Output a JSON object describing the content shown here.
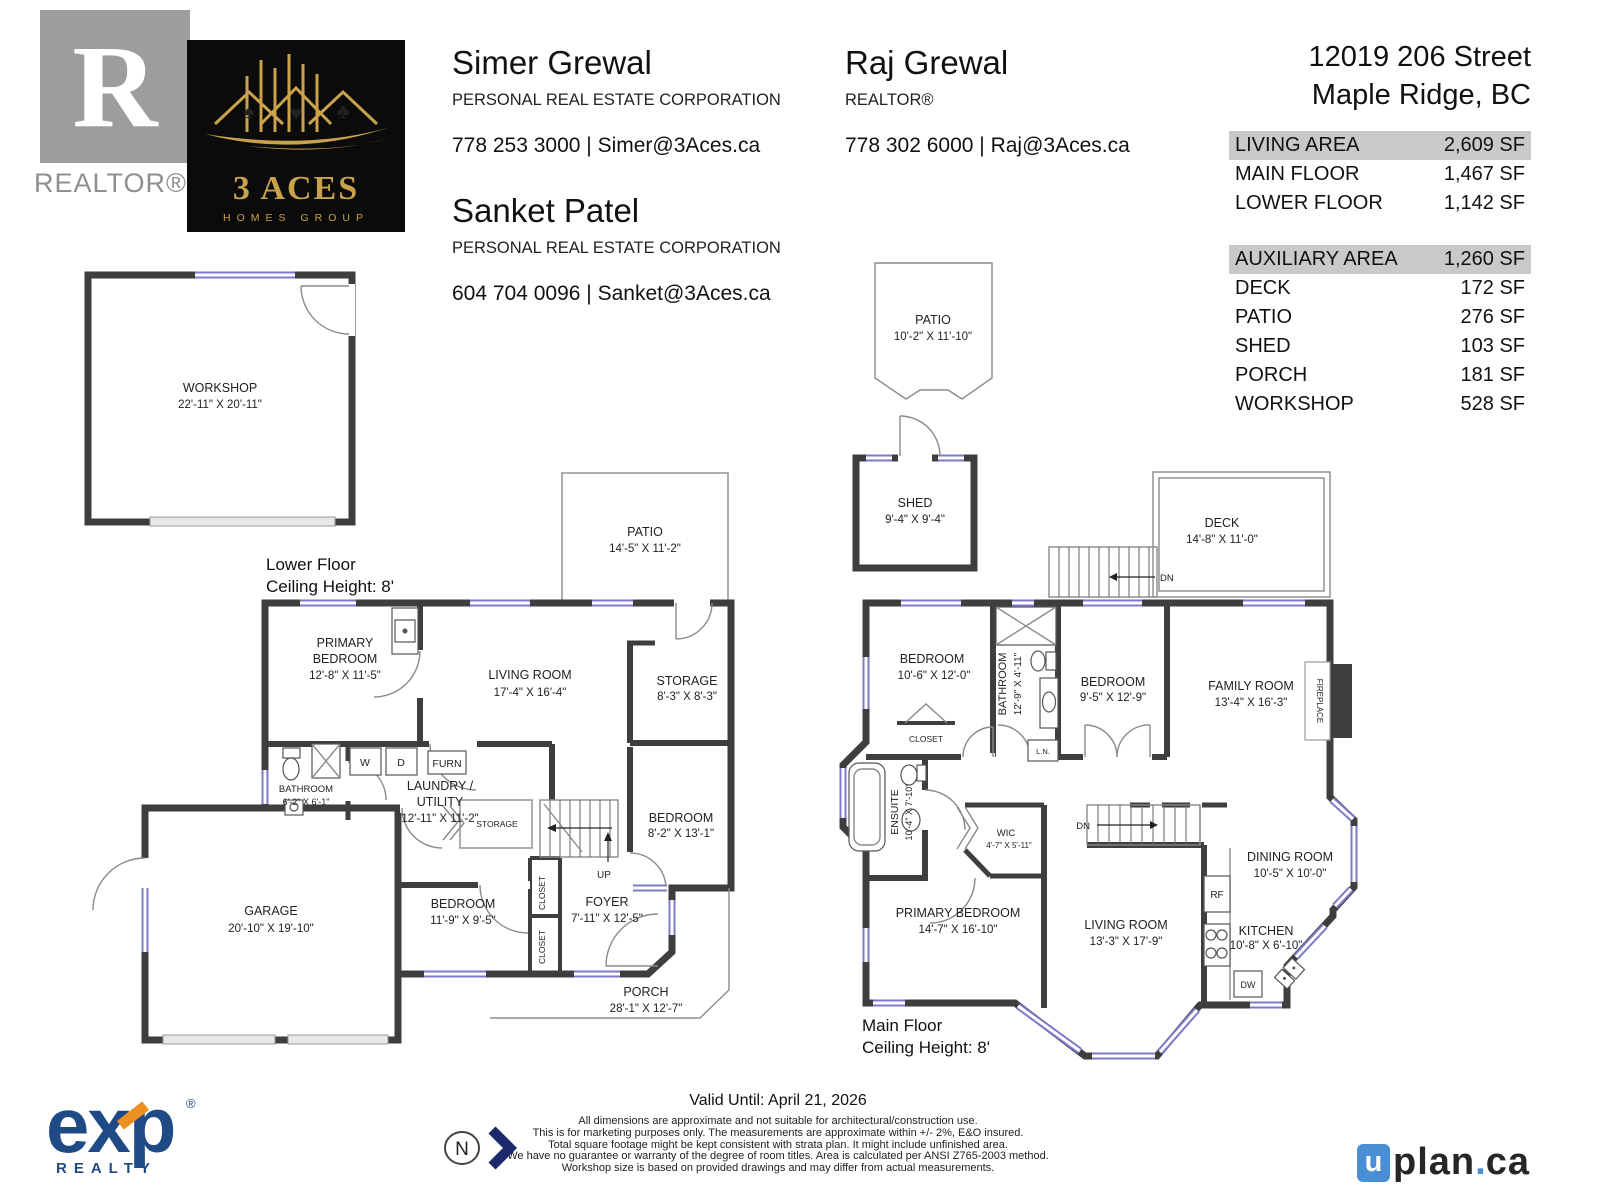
{
  "header": {
    "realtor_mark": {
      "letter": "R",
      "label": "REALTOR®"
    },
    "brokerage": {
      "name": "3 ACES",
      "sub": "HOMES GROUP"
    },
    "agents": [
      {
        "name": "Simer Grewal",
        "title": "PERSONAL REAL ESTATE CORPORATION",
        "contact": "778 253 3000 | Simer@3Aces.ca"
      },
      {
        "name": "Raj Grewal",
        "title": "REALTOR®",
        "contact": "778 302 6000 | Raj@3Aces.ca"
      },
      {
        "name": "Sanket Patel",
        "title": "PERSONAL REAL ESTATE CORPORATION",
        "contact": "604 704 0096 | Sanket@3Aces.ca"
      }
    ],
    "address": {
      "line1": "12019 206 Street",
      "line2": "Maple Ridge, BC"
    }
  },
  "areas": {
    "living": {
      "header_label": "LIVING AREA",
      "header_value": "2,609 SF",
      "rows": [
        {
          "label": "MAIN FLOOR",
          "value": "1,467 SF"
        },
        {
          "label": "LOWER FLOOR",
          "value": "1,142 SF"
        }
      ]
    },
    "auxiliary": {
      "header_label": "AUXILIARY AREA",
      "header_value": "1,260 SF",
      "rows": [
        {
          "label": "DECK",
          "value": "172 SF"
        },
        {
          "label": "PATIO",
          "value": "276 SF"
        },
        {
          "label": "SHED",
          "value": "103 SF"
        },
        {
          "label": "PORCH",
          "value": "181 SF"
        },
        {
          "label": "WORKSHOP",
          "value": "528 SF"
        }
      ]
    }
  },
  "lower": {
    "floor_label": "Lower Floor",
    "ceiling_label": "Ceiling Height: 8'",
    "workshop_name": "WORKSHOP",
    "workshop_dims": "22'-11\" X 20'-11\"",
    "patio_name": "PATIO",
    "patio_dims": "14'-5\" X 11'-2\"",
    "primary_name1": "PRIMARY",
    "primary_name2": "BEDROOM",
    "primary_dims": "12'-8\" X 11'-5\"",
    "living_name": "LIVING ROOM",
    "living_dims": "17'-4\" X 16'-4\"",
    "storage_name": "STORAGE",
    "storage_dims": "8'-3\" X 8'-3\"",
    "bathroom_name": "BATHROOM",
    "bathroom_dims": "6'-2\" X 6'-1\"",
    "laundry_name1": "LAUNDRY /",
    "laundry_name2": "UTILITY",
    "laundry_dims": "12'-11\" X 11'-2\"",
    "washer": "W",
    "dryer": "D",
    "furnace": "FURN",
    "storage_small": "STORAGE",
    "up": "UP",
    "bedroom_r_name": "BEDROOM",
    "bedroom_r_dims": "8'-2\" X 13'-1\"",
    "garage_name": "GARAGE",
    "garage_dims": "20'-10\" X 19'-10\"",
    "bedroom_m_name": "BEDROOM",
    "bedroom_m_dims": "11'-9\" X 9'-5\"",
    "closet": "CLOSET",
    "foyer_name": "FOYER",
    "foyer_dims": "7'-11\" X 12'-5\"",
    "porch_name": "PORCH",
    "porch_dims": "28'-1\" X 12'-7\""
  },
  "main": {
    "floor_label": "Main Floor",
    "ceiling_label": "Ceiling Height: 8'",
    "patio_name": "PATIO",
    "patio_dims": "10'-2\" X 11'-10\"",
    "shed_name": "SHED",
    "shed_dims": "9'-4\" X 9'-4\"",
    "deck_name": "DECK",
    "deck_dims": "14'-8\" X 11'-0\"",
    "dn": "DN",
    "bedroom1_name": "BEDROOM",
    "bedroom1_dims": "10'-6\" X 12'-0\"",
    "bathroom_name": "BATHROOM",
    "bathroom_dims": "12'-9\" X 4'-11\"",
    "bedroom2_name": "BEDROOM",
    "bedroom2_dims": "9'-5\" X 12'-9\"",
    "family_name": "FAMILY ROOM",
    "family_dims": "13'-4\" X 16'-3\"",
    "fireplace": "FIREPLACE",
    "closet": "CLOSET",
    "linen": "L.N.",
    "ensuite_name": "ENSUITE",
    "ensuite_dims": "10'-4\" X 7'-10\"",
    "wic_name": "WIC",
    "wic_dims": "4'-7\" X 5'-11\"",
    "primary_name": "PRIMARY BEDROOM",
    "primary_dims": "14'-7\" X 16'-10\"",
    "living_name": "LIVING ROOM",
    "living_dims": "13'-3\" X 17'-9\"",
    "dining_name": "DINING ROOM",
    "dining_dims": "10'-5\" X 10'-0\"",
    "kitchen_name": "KITCHEN",
    "kitchen_dims": "10'-8\" X 6'-10\"",
    "fridge": "RF",
    "dishwasher": "DW"
  },
  "footer": {
    "valid_until": "Valid Until: April 21, 2026",
    "disclaimer": [
      "All dimensions are approximate and not suitable for architectural/construction use.",
      "This is for marketing purposes only. The measurements are approximate within +/- 2%, E&O insured.",
      "Total square footage might be kept consistent with strata plan. It might include unfinished area.",
      "We have no guarantee or warranty of the degree of room titles. Area is calculated per ANSI Z765-2003 method.",
      "Workshop size is based on provided drawings and may differ from actual measurements."
    ],
    "north": "N",
    "exp_name": "exp",
    "exp_sub": "REALTY",
    "exp_reg": "®",
    "uplan_u": "u",
    "uplan_plan": "plan",
    "uplan_dot": ".",
    "uplan_ca": "ca"
  }
}
